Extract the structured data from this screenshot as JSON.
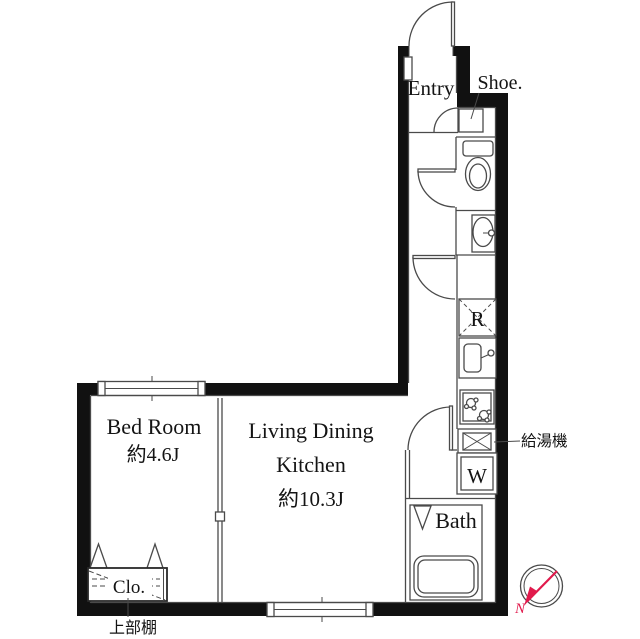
{
  "labels": {
    "entry": "Entry",
    "shoe": "Shoe.",
    "bedroom_name": "Bed Room",
    "bedroom_size": "約4.6J",
    "ldk_line1": "Living Dining",
    "ldk_line2": "Kitchen",
    "ldk_line3": "約10.3J",
    "bath": "Bath",
    "closet": "Clo.",
    "upper_shelf": "上部棚",
    "water_heater": "給湯機",
    "refrigerator": "R",
    "washer": "W",
    "north": "N"
  },
  "colors": {
    "wall": "#111111",
    "line": "#4a4a4a",
    "text": "#141414",
    "compass_needle": "#e11a4c",
    "background": "#ffffff"
  }
}
